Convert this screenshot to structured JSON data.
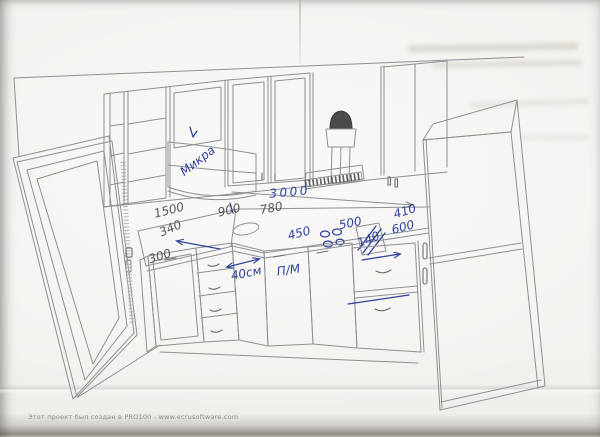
{
  "paper": {
    "watermark": "Этот проект был создан в PRO100 - www.ecrusoftware.com"
  },
  "drawing": {
    "kind": "hand-annotated kitchen perspective sketch",
    "dims": {
      "d1500": "1500",
      "d900": "900",
      "d780": "780",
      "d340": "340",
      "d300": "300",
      "d3000": "3000",
      "d450": "450",
      "d500": "500",
      "d410": "410",
      "d600": "600",
      "d140": "140",
      "d40": "40см"
    },
    "labels": {
      "microwave": "Микра",
      "appliance": "П/М"
    },
    "colors": {
      "paper": "#f2f1ee",
      "pencil": "#8e9094",
      "pencil_dark": "#55565c",
      "pen_blue": "#31429b"
    }
  }
}
